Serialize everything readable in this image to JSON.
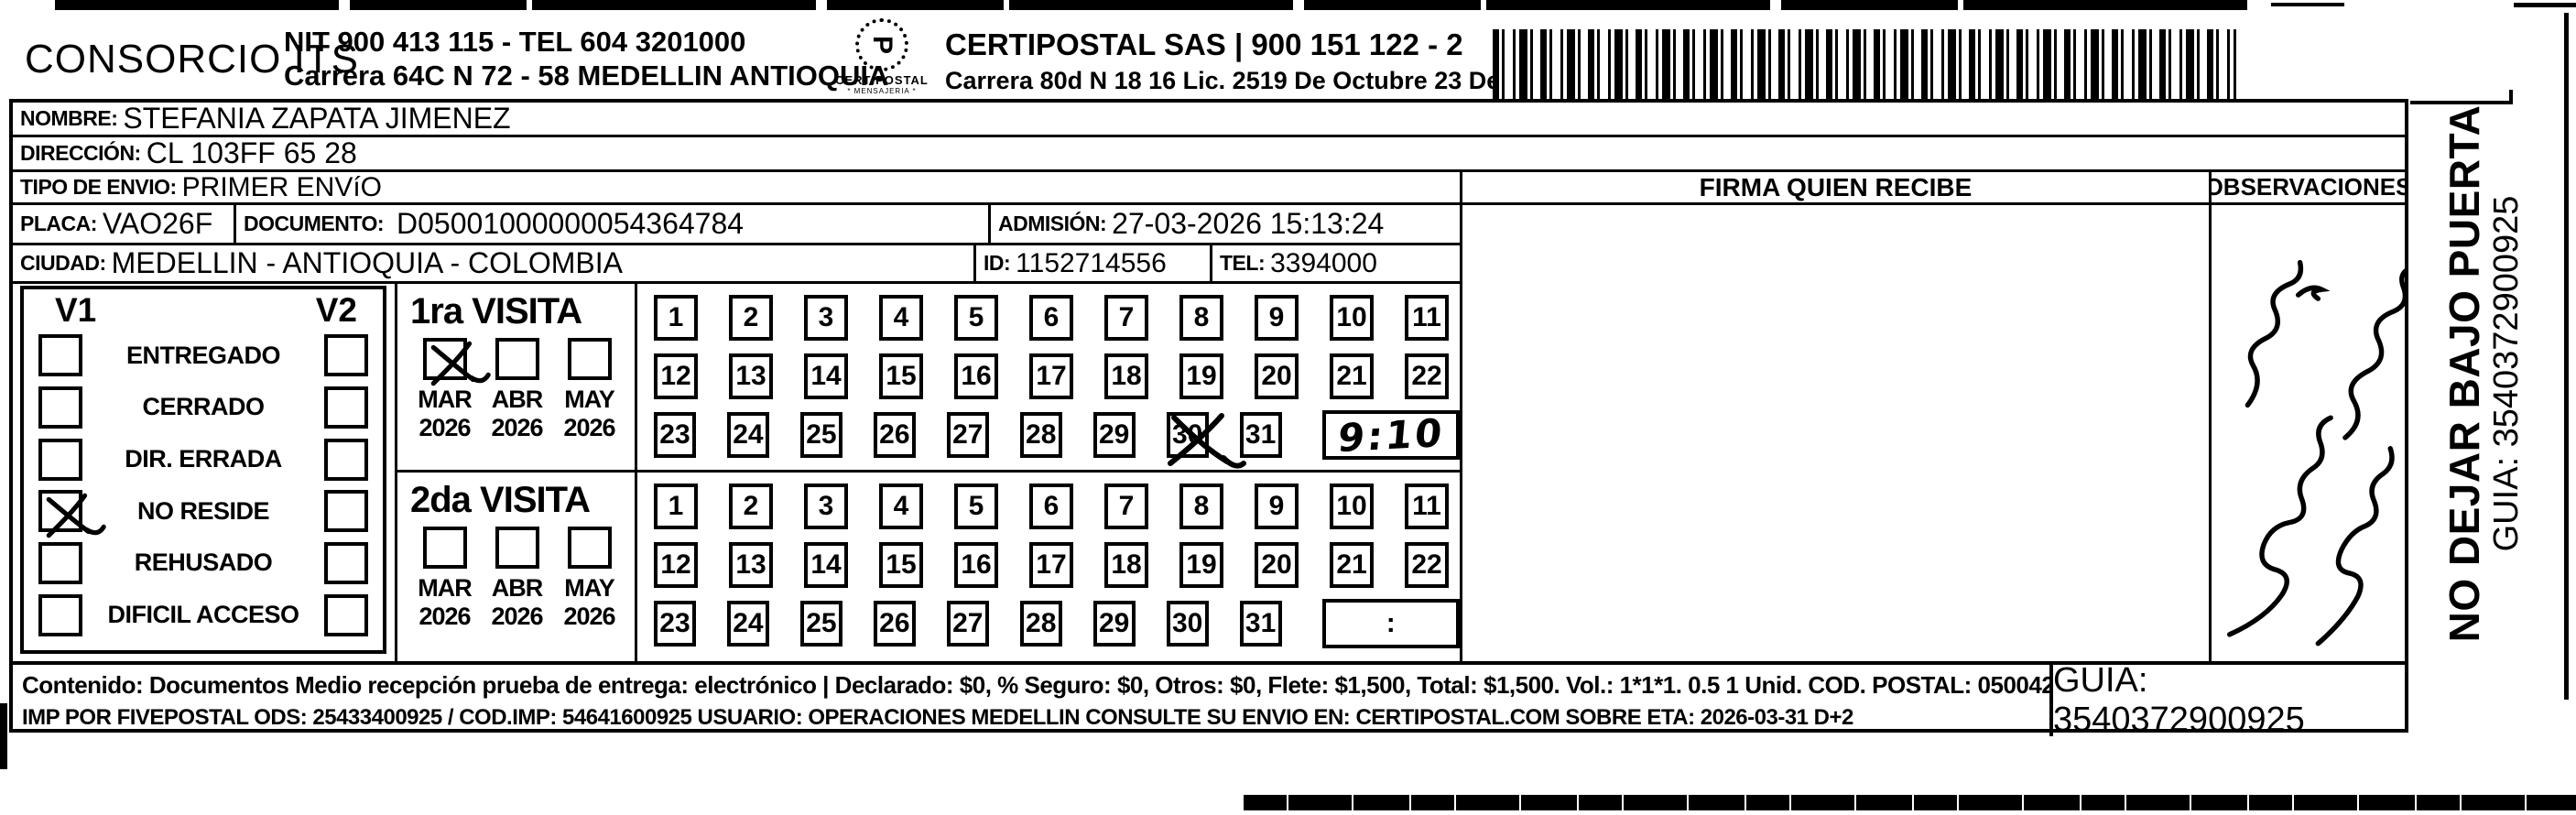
{
  "header": {
    "company": "CONSORCIO ITS",
    "nit_line": "NIT 900 413 115 - TEL 604 3201000",
    "address_line": "Carrera 64C N 72 - 58 MEDELLIN ANTIOQUIA",
    "logo_glyph": "P",
    "logo_caption": "CERTIPOSTAL",
    "logo_subcaption": "* MENSAJERIA *",
    "postal_company": "CERTIPOSTAL SAS | 900 151 122 - 2",
    "postal_address": "Carrera 80d N 18 16  Lic. 2519 De Octubre 23 De 2015"
  },
  "recipient": {
    "nombre_label": "NOMBRE:",
    "nombre": "STEFANIA ZAPATA JIMENEZ",
    "direccion_label": "DIRECCIÓN:",
    "direccion": "CL 103FF 65 28",
    "tipo_envio_label": "TIPO DE ENVIO:",
    "tipo_envio": "PRIMER ENVíO",
    "placa_label": "PLACA:",
    "placa": "VAO26F",
    "documento_label": "DOCUMENTO:",
    "documento": "D05001000000054364784",
    "admision_label": "ADMISIÓN:",
    "admision": "27-03-2026 15:13:24",
    "ciudad_label": "CIUDAD:",
    "ciudad": "MEDELLIN - ANTIOQUIA - COLOMBIA",
    "id_label": "ID:",
    "id_value": "1152714556",
    "tel_label": "TEL:",
    "tel": "3394000"
  },
  "status_panel": {
    "col1_header": "V1",
    "col2_header": "V2",
    "options": [
      {
        "label": "ENTREGADO",
        "v1": false,
        "v2": false
      },
      {
        "label": "CERRADO",
        "v1": false,
        "v2": false
      },
      {
        "label": "DIR. ERRADA",
        "v1": false,
        "v2": false
      },
      {
        "label": "NO RESIDE",
        "v1": true,
        "v2": false
      },
      {
        "label": "REHUSADO",
        "v1": false,
        "v2": false
      },
      {
        "label": "DIFICIL ACCESO",
        "v1": false,
        "v2": false
      }
    ]
  },
  "visita1": {
    "title": "1ra VISITA",
    "months": [
      {
        "label": "MAR",
        "year": "2026",
        "checked": true
      },
      {
        "label": "ABR",
        "year": "2026",
        "checked": false
      },
      {
        "label": "MAY",
        "year": "2026",
        "checked": false
      }
    ],
    "day_rows": [
      [
        1,
        2,
        3,
        4,
        5,
        6,
        7,
        8,
        9,
        10,
        11
      ],
      [
        12,
        13,
        14,
        15,
        16,
        17,
        18,
        19,
        20,
        21,
        22
      ],
      [
        23,
        24,
        25,
        26,
        27,
        28,
        29,
        30,
        31
      ]
    ],
    "crossed_days": [
      30
    ],
    "time": "9:10",
    "time_style": "handwritten"
  },
  "visita2": {
    "title": "2da VISITA",
    "months": [
      {
        "label": "MAR",
        "year": "2026",
        "checked": false
      },
      {
        "label": "ABR",
        "year": "2026",
        "checked": false
      },
      {
        "label": "MAY",
        "year": "2026",
        "checked": false
      }
    ],
    "day_rows": [
      [
        1,
        2,
        3,
        4,
        5,
        6,
        7,
        8,
        9,
        10,
        11
      ],
      [
        12,
        13,
        14,
        15,
        16,
        17,
        18,
        19,
        20,
        21,
        22
      ],
      [
        23,
        24,
        25,
        26,
        27,
        28,
        29,
        30,
        31
      ]
    ],
    "crossed_days": [],
    "time": ":",
    "time_style": "printed"
  },
  "firma": {
    "header": "FIRMA QUIEN RECIBE"
  },
  "observaciones": {
    "header": "OBSERVACIONES"
  },
  "side_strip": {
    "line1": "NO DEJAR BAJO PUERTA",
    "line2": "GUIA: 3540372900925"
  },
  "footer": {
    "line1": "Contenido: Documentos Medio recepción prueba de entrega: electrónico | Declarado: $0, % Seguro: $0, Otros: $0, Flete: $1,500, Total: $1,500. Vol.: 1*1*1. 0.5  1 Unid. COD. POSTAL: 050042",
    "line2": "IMP POR FIVEPOSTAL ODS: 25433400925 / COD.IMP: 54641600925 USUARIO: OPERACIONES MEDELLIN CONSULTE SU ENVIO EN: CERTIPOSTAL.COM SOBRE ETA: 2026-03-31 D+2",
    "guia": "GUIA: 3540372900925"
  },
  "colors": {
    "ink": "#000000",
    "paper": "#ffffff"
  }
}
